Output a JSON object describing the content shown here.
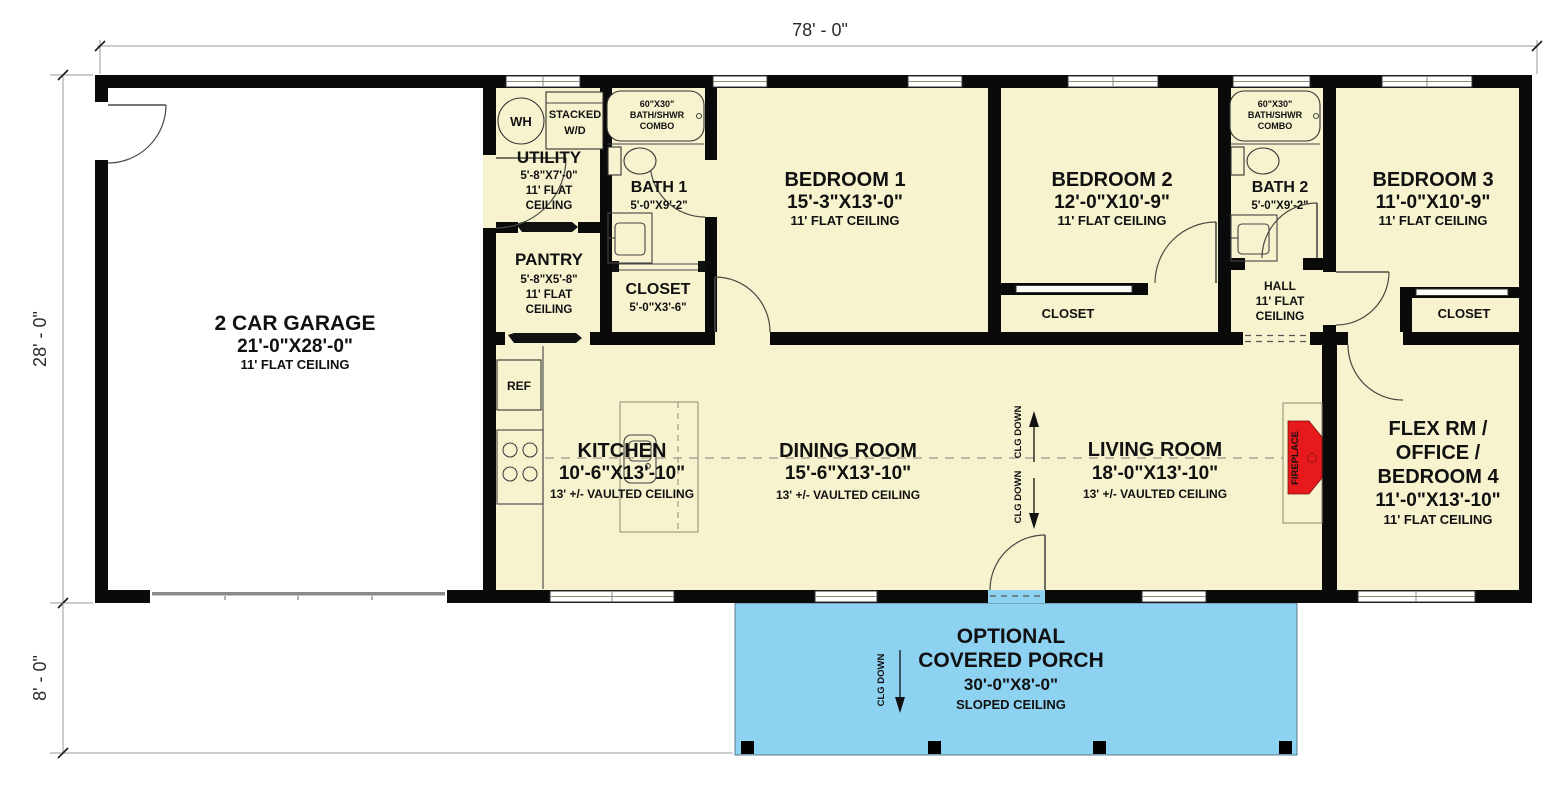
{
  "plan_title": "single story house floor plan",
  "colors": {
    "floor": "#f7f3cf",
    "garage_floor": "#ffffff",
    "porch": "#8ed2f2",
    "wall": "#0a0a0a",
    "fireplace_red": "#e8191c",
    "dim_line": "#9a9a9a"
  },
  "dimensions": {
    "top_width": "78' - 0\"",
    "left_height_main": "28' - 0\"",
    "left_height_porch": "8' - 0\""
  },
  "rooms": {
    "garage": {
      "name": "2 CAR GARAGE",
      "size": "21'-0\"X28'-0\"",
      "ceiling": "11' FLAT CEILING"
    },
    "utility": {
      "name": "UTILITY",
      "size": "5'-8\"X7'-0\"",
      "ceiling1": "11' FLAT",
      "ceiling2": "CEILING"
    },
    "pantry": {
      "name": "PANTRY",
      "size": "5'-8\"X5'-8\"",
      "ceiling1": "11' FLAT",
      "ceiling2": "CEILING"
    },
    "bath1": {
      "name": "BATH 1",
      "size": "5'-0\"X9'-2\""
    },
    "closet1": {
      "name": "CLOSET",
      "size": "5'-0\"X3'-6\""
    },
    "bedroom1": {
      "name": "BEDROOM 1",
      "size": "15'-3\"X13'-0\"",
      "ceiling": "11' FLAT CEILING"
    },
    "bedroom2": {
      "name": "BEDROOM 2",
      "size": "12'-0\"X10'-9\"",
      "ceiling": "11' FLAT CEILING"
    },
    "closet2": {
      "name": "CLOSET"
    },
    "bath2": {
      "name": "BATH 2",
      "size": "5'-0\"X9'-2\""
    },
    "hall": {
      "name": "HALL",
      "ceiling1": "11' FLAT",
      "ceiling2": "CEILING"
    },
    "bedroom3": {
      "name": "BEDROOM 3",
      "size": "11'-0\"X10'-9\"",
      "ceiling": "11' FLAT CEILING"
    },
    "closet3": {
      "name": "CLOSET"
    },
    "kitchen": {
      "name": "KITCHEN",
      "size": "10'-6\"X13'-10\"",
      "ceiling": "13' +/- VAULTED CEILING"
    },
    "dining": {
      "name": "DINING ROOM",
      "size": "15'-6\"X13'-10\"",
      "ceiling": "13' +/- VAULTED CEILING"
    },
    "living": {
      "name": "LIVING ROOM",
      "size": "18'-0\"X13'-10\"",
      "ceiling": "13' +/- VAULTED CEILING"
    },
    "flex": {
      "name1": "FLEX RM /",
      "name2": "OFFICE /",
      "name3": "BEDROOM 4",
      "size": "11'-0\"X13'-10\"",
      "ceiling": "11' FLAT CEILING"
    },
    "porch": {
      "name1": "OPTIONAL",
      "name2": "COVERED PORCH",
      "size": "30'-0\"X8'-0\"",
      "ceiling": "SLOPED CEILING"
    }
  },
  "fixtures": {
    "water_heater": "WH",
    "washer_dryer1": "STACKED",
    "washer_dryer2": "W/D",
    "tub1": "60\"X30\"",
    "tub2": "BATH/SHWR",
    "tub3": "COMBO",
    "refrigerator": "REF",
    "fireplace": "FIREPLACE",
    "clg_down": "CLG DOWN"
  }
}
